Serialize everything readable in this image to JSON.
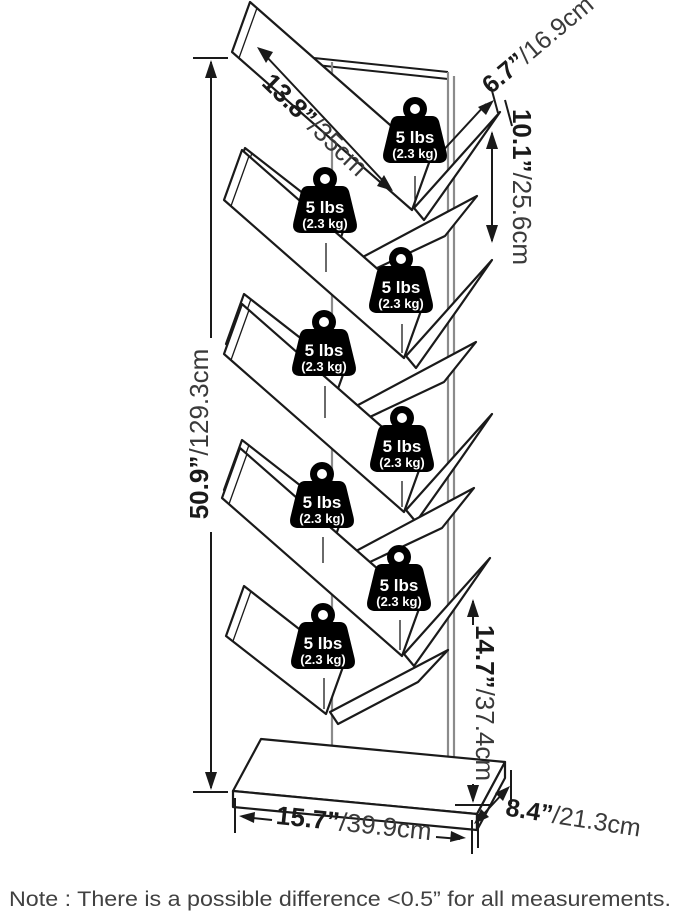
{
  "diagram": {
    "product": "tree bookshelf dimension diagram",
    "tiers": 8
  },
  "weight_badge": {
    "line1": "5 lbs",
    "line2": "(2.3 kg)",
    "count": 8
  },
  "dims": {
    "shelf_length": {
      "in": "13.8”",
      "cm": "/35cm"
    },
    "shelf_depth": {
      "in": "6.7”",
      "cm": "/16.9cm"
    },
    "tier_gap": {
      "in": "10.1”",
      "cm": "/25.6cm"
    },
    "overall_height": {
      "in": "50.9”",
      "cm": "/129.3cm"
    },
    "base_clearance": {
      "in": "14.7”",
      "cm": "/37.4cm"
    },
    "base_width": {
      "in": "15.7”",
      "cm": "/39.9cm"
    },
    "base_depth": {
      "in": "8.4”",
      "cm": "/21.3cm"
    }
  },
  "note": "Note : There is a possible difference <0.5” for all measurements.",
  "colors": {
    "line": "#1a1a1a",
    "spine": "#8b8b8b",
    "badge": "#000000",
    "badge_text": "#ffffff",
    "background": "#ffffff",
    "note_text": "#414141",
    "metric_text": "#3a3a3a"
  }
}
